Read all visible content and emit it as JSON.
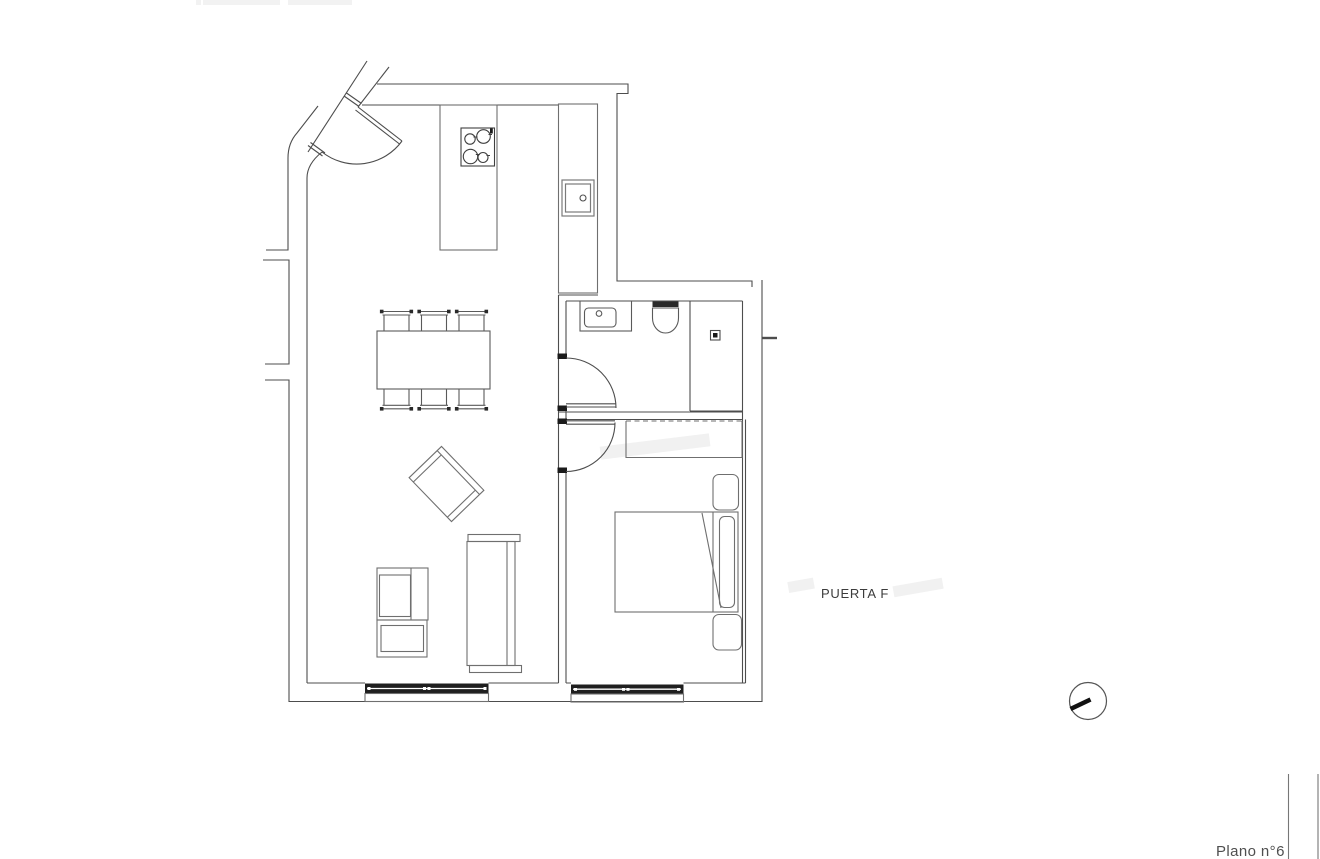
{
  "page": {
    "width": 1320,
    "height": 859,
    "background": "#ffffff"
  },
  "labels": {
    "door": "PUERTA F",
    "sheet": "Plano n°6"
  },
  "colors": {
    "wall_line": "#4d4d4d",
    "furniture_line": "#6f6f6f",
    "window_fill": "#1f1f1f",
    "jamb_fill": "#1a1a1a",
    "label_text": "#3c3c3c",
    "sheet_text": "#4f4f4f",
    "faint_header": "#f2f2f2",
    "north_needle": "#111111"
  },
  "symbols": {
    "north_indicator": "circle-with-needle",
    "entry_door": "quarter-arc-door",
    "bathroom_door": "quarter-arc-door",
    "bedroom_door": "quarter-arc-door",
    "stove": "four-burner-cooktop",
    "windows_count": 2
  }
}
